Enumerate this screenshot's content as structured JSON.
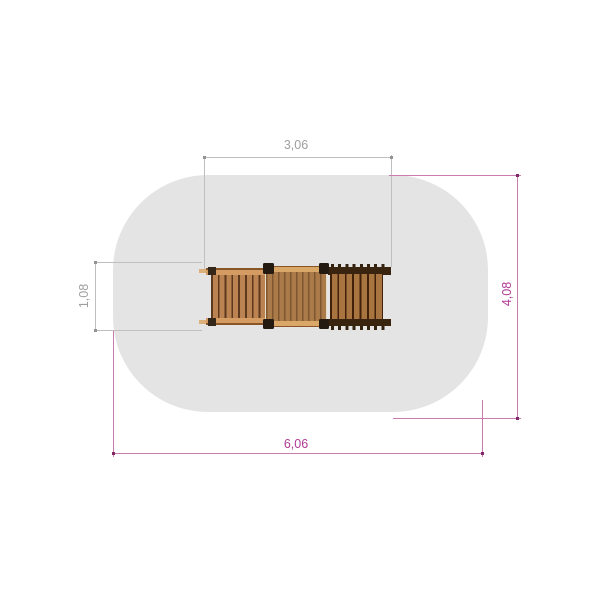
{
  "dimensions": {
    "structure_width": "3,06",
    "structure_depth": "1,08",
    "area_depth": "4,08",
    "area_width": "6,06"
  },
  "colors": {
    "safety_area_fill": "#e4e4e4",
    "dimension_gray_line": "#bfbfbf",
    "dimension_gray_text": "#9e9e9e",
    "dimension_magenta_line": "#c97cb0",
    "dimension_magenta_text": "#b13a94",
    "wood_rail": "#d49c62",
    "wood_ladder_slat": "#bc8352",
    "wood_deck_plank": "#aa7b48",
    "wood_dark_rail": "#38240f",
    "corner_post": "#241a10"
  },
  "parts": {
    "safety_area": "safety-area",
    "ladder": "climbing-ladder-topview",
    "platform": "platform-topview",
    "bridge": "bridge-topview"
  }
}
